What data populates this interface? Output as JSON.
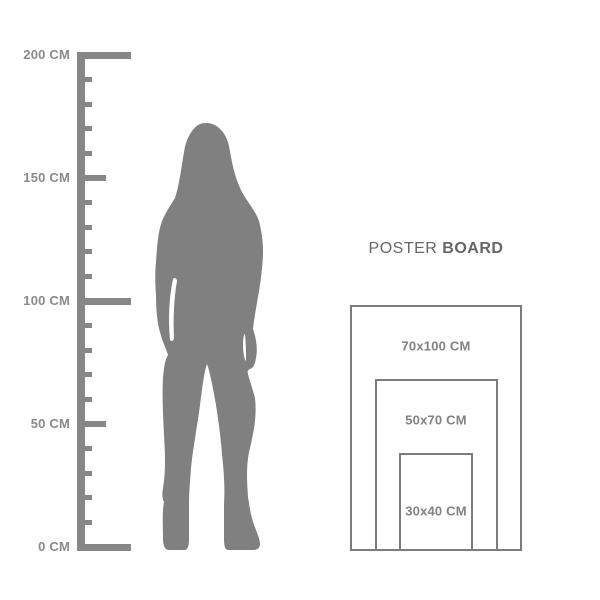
{
  "page": {
    "background_color": "#ffffff"
  },
  "ruler": {
    "unit": "CM",
    "min_cm": 0,
    "max_cm": 200,
    "tick_step_cm": 10,
    "color": "#878787",
    "label_color": "#8a8a8a",
    "labels": [
      {
        "cm": 200,
        "text": "200 CM"
      },
      {
        "cm": 150,
        "text": "150 CM"
      },
      {
        "cm": 100,
        "text": "100 CM"
      },
      {
        "cm": 50,
        "text": "50 CM"
      },
      {
        "cm": 0,
        "text": "0 CM"
      }
    ]
  },
  "silhouette": {
    "description": "standing-woman-silhouette",
    "color": "#808080"
  },
  "poster_board": {
    "title": {
      "regular": "POSTER",
      "bold": "BOARD",
      "color": "#666668"
    },
    "border_color": "#7b7c7e",
    "label_color": "#828282",
    "sizes": [
      {
        "label": "70x100 CM",
        "width_cm": 70,
        "height_cm": 100
      },
      {
        "label": "50x70 CM",
        "width_cm": 50,
        "height_cm": 70
      },
      {
        "label": "30x40 CM",
        "width_cm": 30,
        "height_cm": 40
      }
    ]
  }
}
